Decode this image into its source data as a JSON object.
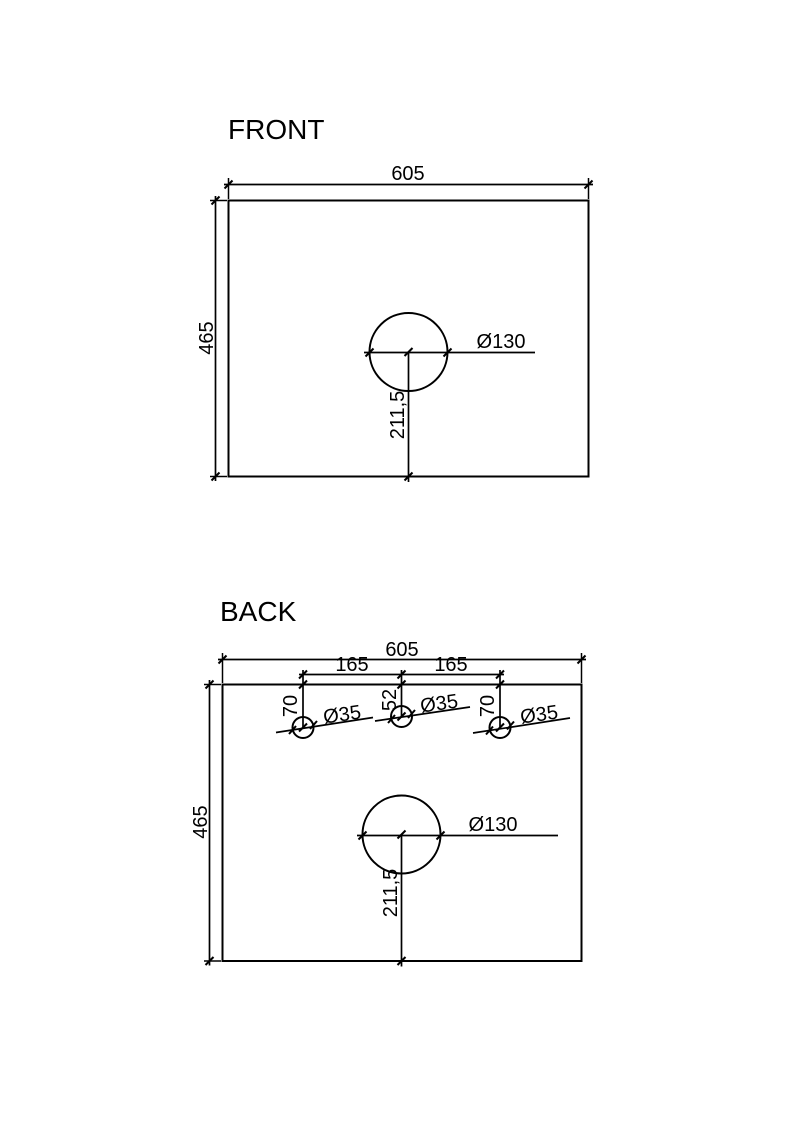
{
  "drawing": {
    "front": {
      "title": "FRONT",
      "width": "605",
      "height": "465",
      "faucet_hole": {
        "diameter": "Ø130",
        "offset_from_bottom": "211,5"
      }
    },
    "back": {
      "title": "BACK",
      "width": "605",
      "height": "465",
      "hole_spacing": [
        "165",
        "165"
      ],
      "tap_holes": [
        {
          "diameter": "Ø35",
          "offset_from_top": "70"
        },
        {
          "diameter": "Ø35",
          "offset_from_top": "52"
        },
        {
          "diameter": "Ø35",
          "offset_from_top": "70"
        }
      ],
      "main_hole": {
        "diameter": "Ø130",
        "offset_from_bottom": "211,5"
      }
    }
  }
}
